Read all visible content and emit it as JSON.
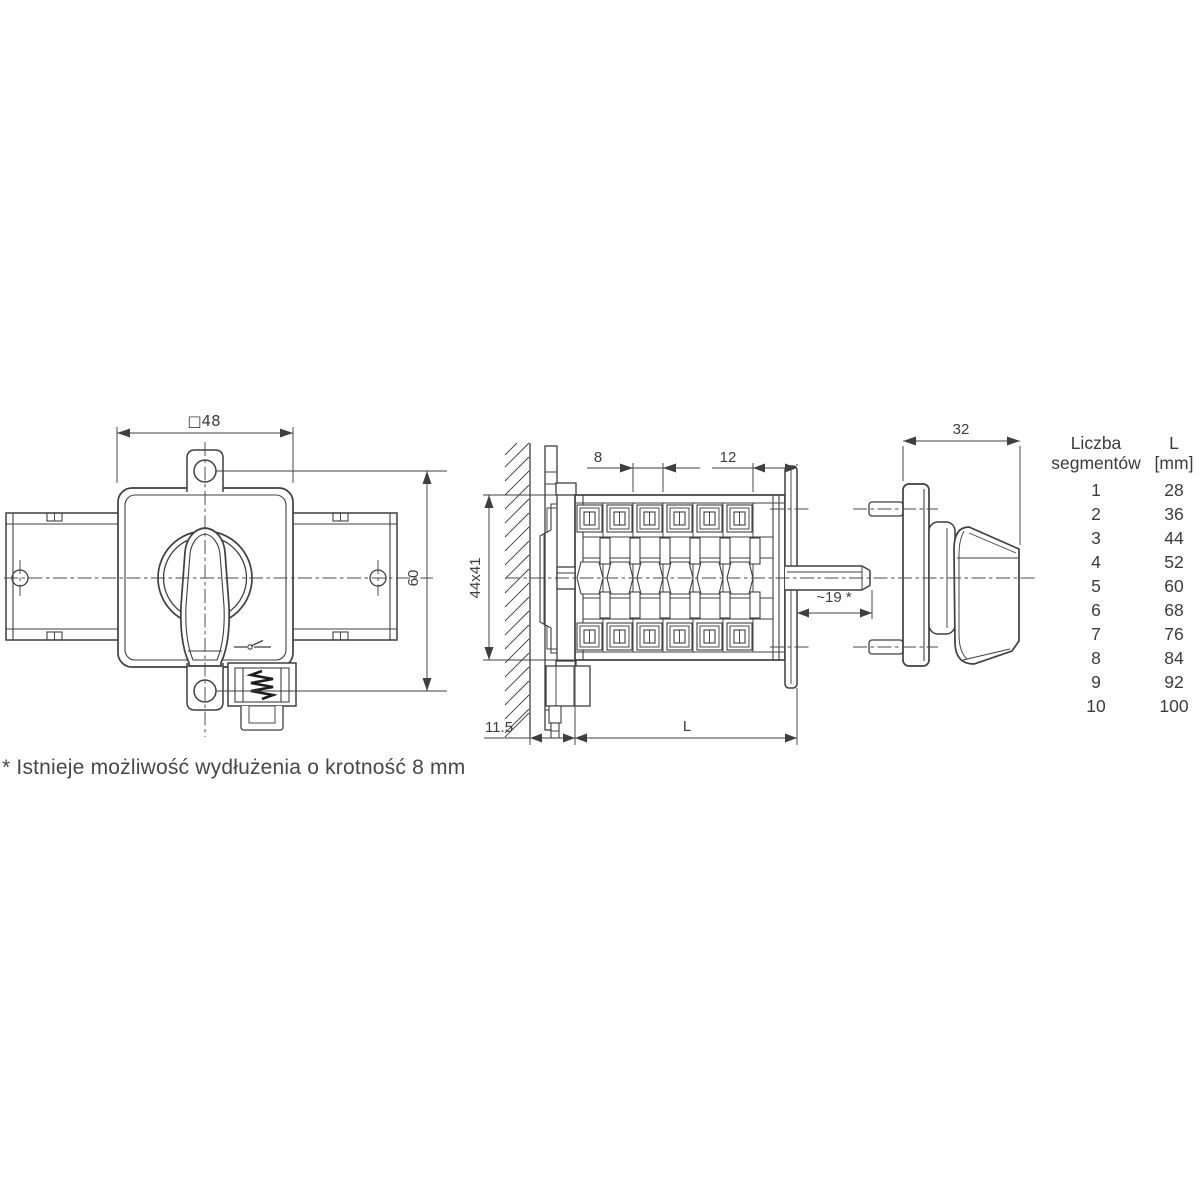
{
  "page": {
    "background_color": "#ffffff",
    "line_color": "#3f3f3f",
    "text_color": "#3d3d3d",
    "description_labels_language": "Polish"
  },
  "views": {
    "front": {
      "width_label": "□48",
      "height_label": "60"
    },
    "side": {
      "segment_pitch_label": "8",
      "end_segment_label": "12",
      "cross_section_label": "44x41",
      "panel_offset_label": "11.5",
      "length_label": "L",
      "shaft_length_label": "~19 *"
    },
    "handle": {
      "depth_label": "32"
    }
  },
  "table": {
    "header": {
      "col1_line1": "Liczba",
      "col1_line2": "segmentów",
      "col2_line1": "L",
      "col2_line2": "[mm]"
    },
    "rows": [
      {
        "segments": "1",
        "length_mm": "28"
      },
      {
        "segments": "2",
        "length_mm": "36"
      },
      {
        "segments": "3",
        "length_mm": "44"
      },
      {
        "segments": "4",
        "length_mm": "52"
      },
      {
        "segments": "5",
        "length_mm": "60"
      },
      {
        "segments": "6",
        "length_mm": "68"
      },
      {
        "segments": "7",
        "length_mm": "76"
      },
      {
        "segments": "8",
        "length_mm": "84"
      },
      {
        "segments": "9",
        "length_mm": "92"
      },
      {
        "segments": "10",
        "length_mm": "100"
      }
    ]
  },
  "footnote": "* Istnieje możliwość wydłużenia o krotność 8 mm"
}
